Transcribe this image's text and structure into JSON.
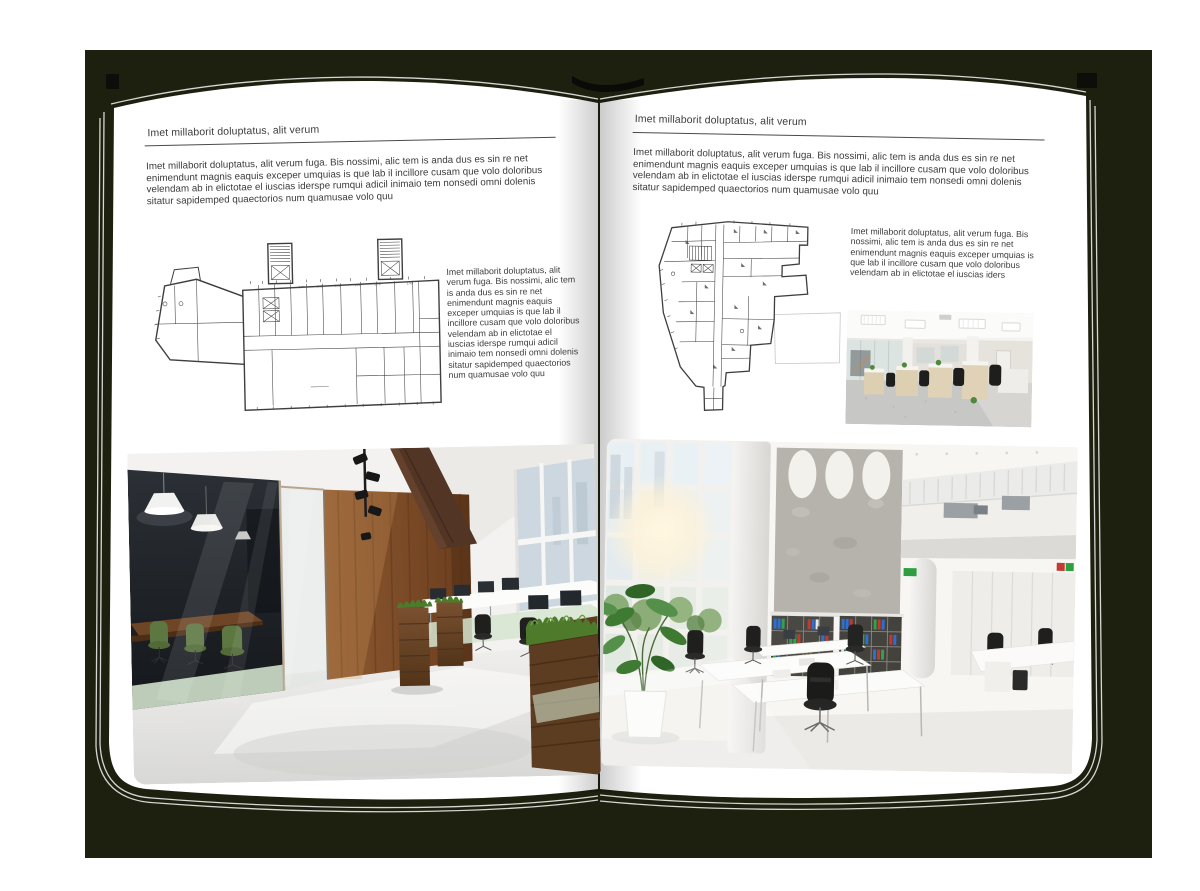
{
  "book": {
    "cover_color": "#1e200f",
    "page_color": "#ffffff",
    "text_color": "#3d3d3d"
  },
  "page_left": {
    "header": "Imet millaborit doluptatus, alit verum",
    "intro": "Imet millaborit doluptatus, alit verum fuga. Bis nossimi, alic tem is anda dus es sin re net enimendunt magnis eaquis exceper umquias is que lab il incillore cusam que volo doloribus velendam ab in elictotae el iuscias iderspe rumqui adicil inimaio tem nonsedi omni dolenis sitatur sapidemped quaectorios num quamusae volo quu",
    "side_text": "Imet millaborit doluptatus, alit verum fuga. Bis nossimi, alic tem is anda dus es sin re net enimendunt magnis eaquis exceper umquias is que lab il incillore cusam que volo doloribus velendam ab in elictotae el iuscias iderspe rumqui adicil inimaio tem nonsedi omni dolenis sitatur sapidemped quaectorios num quamusae volo quu",
    "plan_dims": [
      "2.76",
      "2.95",
      "2.92",
      "3.09",
      "3.76",
      "1.43"
    ]
  },
  "page_right": {
    "header": "Imet millaborit doluptatus, alit verum",
    "intro": "Imet millaborit doluptatus, alit verum fuga. Bis nossimi, alic tem is anda dus es sin re net enimendunt magnis eaquis exceper umquias is que lab il incillore cusam que volo doloribus velendam ab in elictotae el iuscias iderspe rumqui adicil inimaio tem nonsedi omni dolenis sitatur sapidemped quaectorios num quamusae volo quu",
    "side_text": "Imet millaborit doluptatus, alit verum fuga. Bis nossimi, alic tem is anda dus es sin re net enimendunt magnis eaquis exceper umquias is que lab il incillore cusam que volo doloribus velendam ab in elictotae el iuscias iders"
  }
}
